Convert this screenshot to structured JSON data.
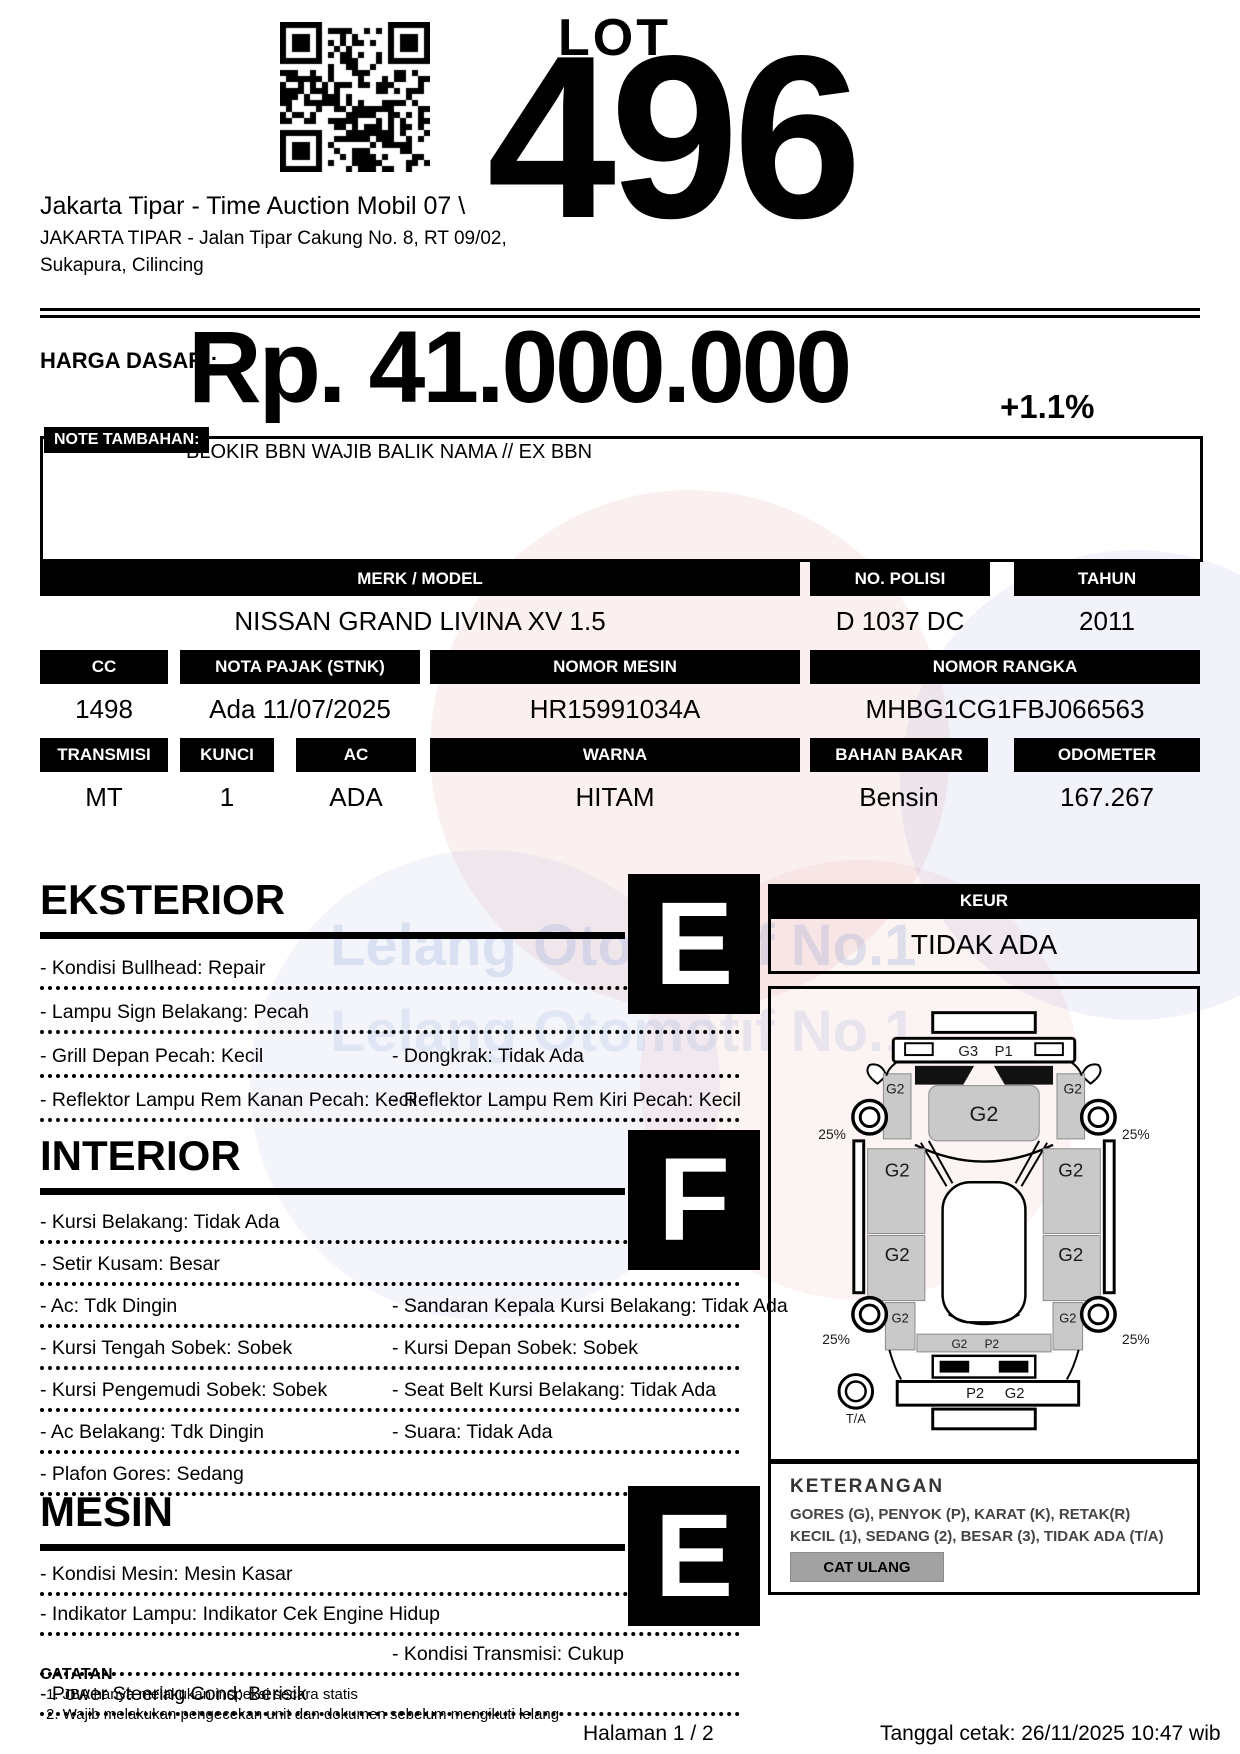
{
  "header": {
    "lot_label": "LOT",
    "lot_number": "496",
    "auction_title": "Jakarta Tipar - Time Auction Mobil 07 \\",
    "address_line1": "JAKARTA TIPAR - Jalan Tipar Cakung No. 8, RT 09/02,",
    "address_line2": "Sukapura, Cilincing"
  },
  "price": {
    "label": "HARGA DASAR :",
    "value": "Rp. 41.000.000",
    "change": "+1.1%"
  },
  "note": {
    "label": "NOTE TAMBAHAN:",
    "text": "BLOKIR BBN WAJIB BALIK NAMA // EX BBN"
  },
  "table": {
    "merk_model_label": "MERK / MODEL",
    "merk_model": "NISSAN GRAND LIVINA XV 1.5",
    "no_polisi_label": "NO. POLISI",
    "no_polisi": "D 1037 DC",
    "tahun_label": "TAHUN",
    "tahun": "2011",
    "cc_label": "CC",
    "cc": "1498",
    "nota_pajak_label": "NOTA PAJAK (STNK)",
    "nota_pajak": "Ada 11/07/2025",
    "nomor_mesin_label": "NOMOR MESIN",
    "nomor_mesin": "HR15991034A",
    "nomor_rangka_label": "NOMOR RANGKA",
    "nomor_rangka": "MHBG1CG1FBJ066563",
    "transmisi_label": "TRANSMISI",
    "transmisi": "MT",
    "kunci_label": "KUNCI",
    "kunci": "1",
    "ac_label": "AC",
    "ac": "ADA",
    "warna_label": "WARNA",
    "warna": "HITAM",
    "bahan_bakar_label": "BAHAN BAKAR",
    "bahan_bakar": "Bensin",
    "odometer_label": "ODOMETER",
    "odometer": "167.267"
  },
  "keur": {
    "label": "KEUR",
    "value": "TIDAK ADA"
  },
  "sections": {
    "eksterior": {
      "title": "EKSTERIOR",
      "grade": "E",
      "rows": [
        {
          "left": "- Kondisi Bullhead: Repair",
          "right": ""
        },
        {
          "left": "- Lampu Sign Belakang: Pecah",
          "right": ""
        },
        {
          "left": "- Grill Depan Pecah: Kecil",
          "right": "- Dongkrak: Tidak Ada"
        },
        {
          "left": "- Reflektor Lampu Rem Kanan Pecah: Kecil",
          "right": "- Reflektor Lampu Rem Kiri Pecah: Kecil"
        }
      ]
    },
    "interior": {
      "title": "INTERIOR",
      "grade": "F",
      "rows": [
        {
          "left": "- Kursi Belakang: Tidak Ada",
          "right": ""
        },
        {
          "left": "- Setir Kusam: Besar",
          "right": ""
        },
        {
          "left": "- Ac: Tdk Dingin",
          "right": "- Sandaran Kepala Kursi Belakang: Tidak Ada"
        },
        {
          "left": "- Kursi Tengah Sobek: Sobek",
          "right": "- Kursi Depan Sobek: Sobek"
        },
        {
          "left": "- Kursi Pengemudi Sobek: Sobek",
          "right": "- Seat Belt Kursi Belakang: Tidak Ada"
        },
        {
          "left": "- Ac Belakang: Tdk Dingin",
          "right": "- Suara: Tidak Ada"
        },
        {
          "left": "- Plafon Gores: Sedang",
          "right": ""
        }
      ]
    },
    "mesin": {
      "title": "MESIN",
      "grade": "E",
      "rows": [
        {
          "left": "- Kondisi Mesin: Mesin Kasar",
          "right": ""
        },
        {
          "left": "- Indikator Lampu: Indikator Cek Engine Hidup",
          "right": ""
        },
        {
          "left": "",
          "right": "- Kondisi Transmisi: Cukup"
        },
        {
          "left": "- Power Steering Cond: Berisik",
          "right": ""
        }
      ]
    }
  },
  "diagram": {
    "front_bumper_l": "G3",
    "front_bumper_r": "P1",
    "hood": "G2",
    "fender_left": "G2",
    "fender_right": "G2",
    "door_front_left": "G2",
    "door_front_right": "G2",
    "door_rear_left": "G2",
    "door_rear_right": "G2",
    "quarter_left": "G2",
    "quarter_right": "G2",
    "rear_panel_l": "G2",
    "rear_panel_r": "P2",
    "rear_bumper_l": "P2",
    "rear_bumper_r": "G2",
    "tire_front_left": "25%",
    "tire_front_right": "25%",
    "tire_rear_left": "25%",
    "tire_rear_right": "25%",
    "spare": "T/A"
  },
  "keterangan": {
    "title": "KETERANGAN",
    "line1": "GORES (G), PENYOK (P), KARAT (K), RETAK(R)",
    "line2": "KECIL (1), SEDANG (2), BESAR (3), TIDAK ADA (T/A)",
    "button": "CAT ULANG"
  },
  "catatan": {
    "title": "CATATAN",
    "note1": "1. JBA hanya melakukan inspeksi secara statis",
    "note2": "2. Wajib melakukan pengecekan unit dan dokumen sebelum mengikuti lelang"
  },
  "footer": {
    "page": "Halaman 1 / 2",
    "printed": "Tanggal cetak: 26/11/2025 10:47 wib"
  },
  "watermark": {
    "line1": "Lelang Otomotif No.1",
    "line2": "Lelang Otomotif No.1"
  },
  "colors": {
    "panel_gray": "#c9c9c9",
    "button_gray": "#a2a2a2",
    "watermark_blue": "#7896c8",
    "watermark_red": "#d05050"
  }
}
